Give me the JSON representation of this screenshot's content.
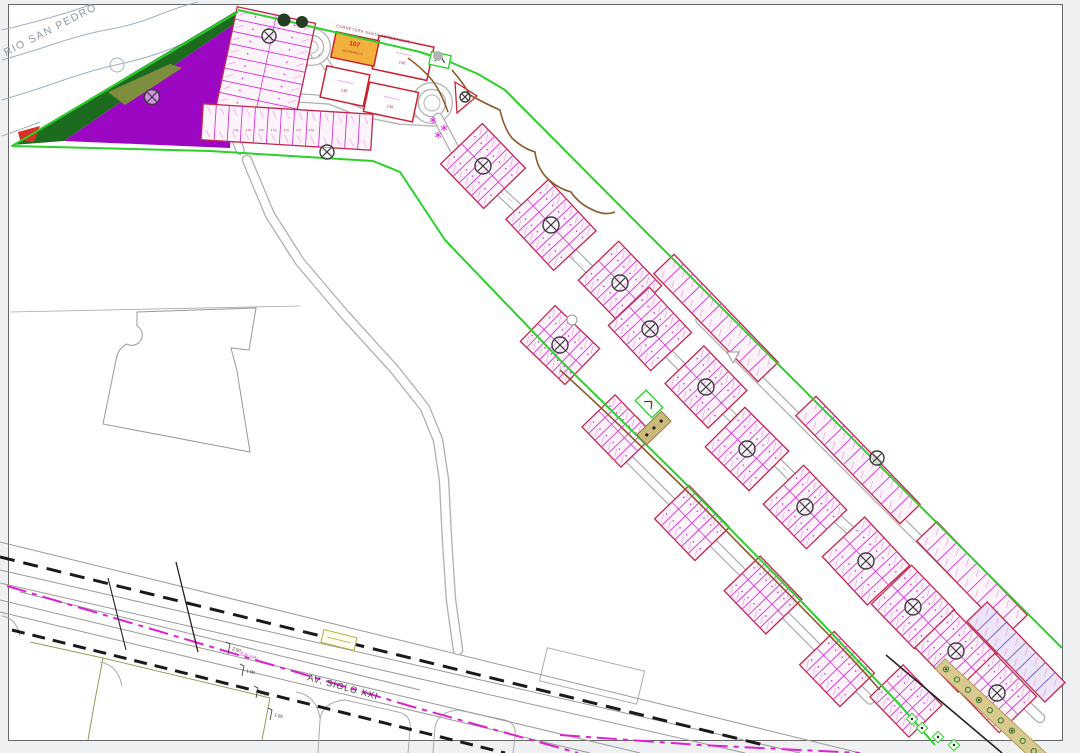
{
  "drawing": {
    "river_label": "RIO SAN PEDRO",
    "avenue_label": "AV. SIGLO XXI",
    "axis_label": "EJE VIAL",
    "top_road_label": "CARRETERA SANTA TERESA SUR",
    "parcels": {
      "orange_number": "107",
      "orange_sublabel": "EQUIPAMIENTO",
      "large_numbers": [
        "146",
        "148",
        "149"
      ]
    },
    "lot_row_numbers": [
      "176",
      "175",
      "174",
      "173",
      "172",
      "171",
      "170"
    ],
    "dimension_values": [
      "2.50",
      "1.00",
      "3.00",
      "1.50"
    ],
    "block_marker_symbol": "circled-x"
  },
  "colors": {
    "boundary_green": "#29d129",
    "forest_green": "#1d6b1f",
    "park_purple": "#9c07c3",
    "olive_green": "#7d8f3c",
    "tip_red": "#d93025",
    "block_border_red": "#c3244a",
    "lot_line_magenta": "#d633d6",
    "lot_hatch_pink": "#ef9ede",
    "lot_fill": "#fdf4fb",
    "equipment_orange": "#f2b13d",
    "axis_magenta": "#e020d0",
    "contour_brown": "#8a5a28",
    "river_blue_gray": "#9fb0c0",
    "row_dash_black": "#1a1a1a",
    "road_gray": "#b0b0b0",
    "marker_gray": "#3c3c3c",
    "tan_strip": "#d9c98f",
    "tree_green": "#2e7d32",
    "purple_strip": "#7e57c2"
  }
}
